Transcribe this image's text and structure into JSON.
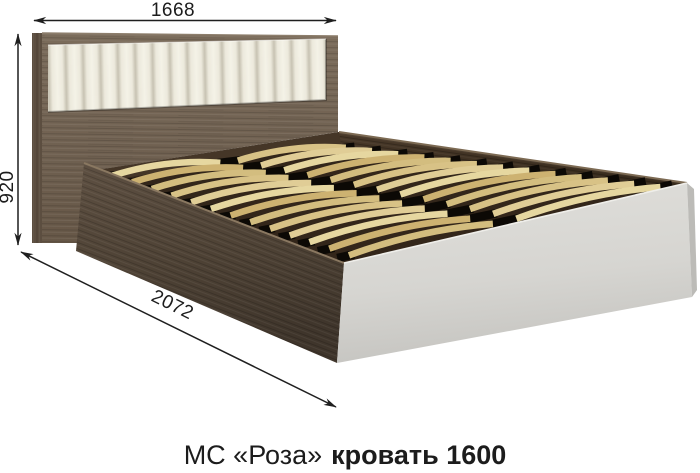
{
  "title": {
    "series": "МС «Роза»",
    "product": "кровать 1600"
  },
  "dimensions": {
    "width": "1668",
    "height": "920",
    "length": "2072"
  },
  "colors": {
    "background": "#ffffff",
    "dimension_line": "#1f1f1f",
    "headboard_wood": "#7364546",
    "headboard_wood_base": "#736454",
    "side_rail_wood": "#55463a",
    "back_rail_wood": "#3b2e21",
    "slat_wood": "#dcc68c",
    "slat_interior": "#35281a",
    "upholstery_insert": "#efece1",
    "foot_panel": "#d9d8d4"
  }
}
